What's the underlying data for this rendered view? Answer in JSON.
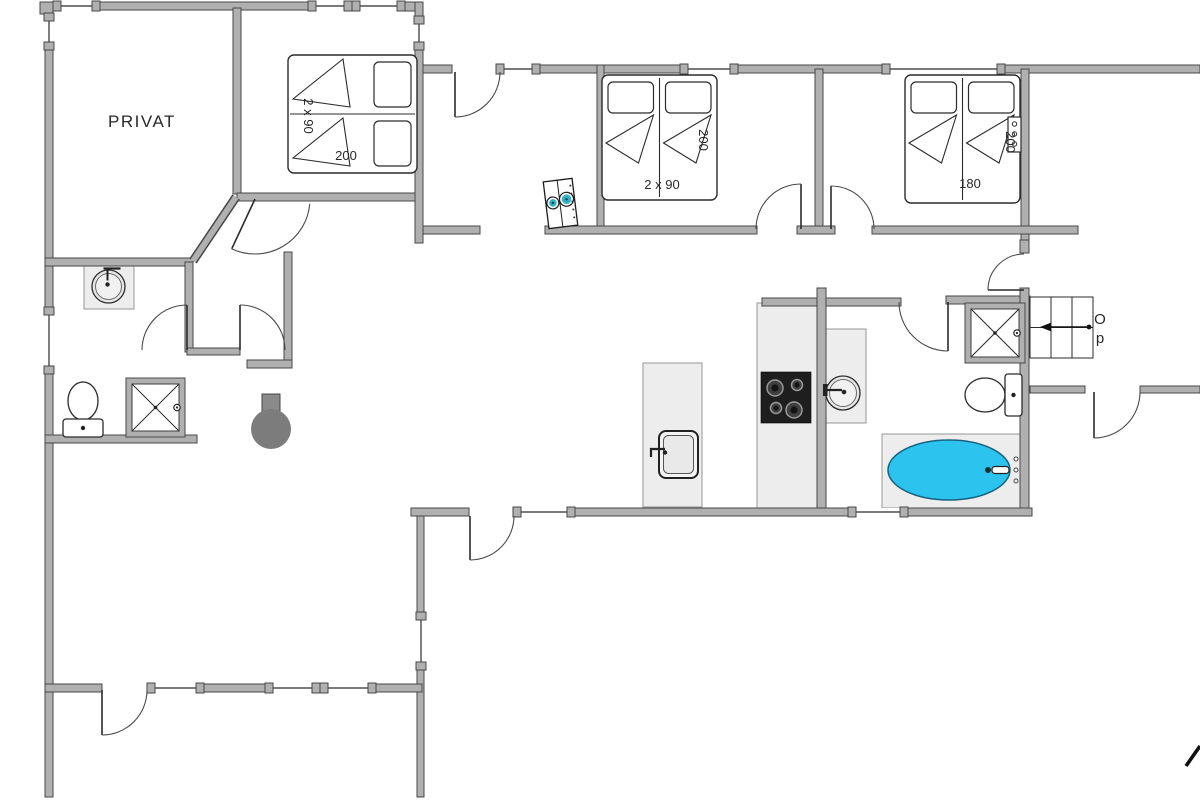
{
  "meta": {
    "width": 1200,
    "height": 800
  },
  "colors": {
    "wall": "#b0b0b0",
    "wallStroke": "#474747",
    "line": "#2b2b2b",
    "door": "#4a4a4a",
    "counter": "#ededed",
    "counterStroke": "#979797",
    "tub": "#2cc3ee",
    "tubStroke": "#16637f",
    "appliance": "#2fb3c4",
    "stove": "#1e1e1e",
    "fireplace": "#7c7c7c",
    "text": "#282828"
  },
  "labels": [
    {
      "id": "privat-room",
      "text": "PRIVAT",
      "x": 142,
      "y": 127,
      "size": 17,
      "rot": 0,
      "ls": 1.5
    },
    {
      "id": "bed-left-size",
      "text": "2 x 90",
      "x": 304,
      "y": 116,
      "size": 13,
      "rot": 90,
      "ls": 0
    },
    {
      "id": "bed-left-length",
      "text": "200",
      "x": 346,
      "y": 160,
      "size": 13,
      "rot": 0,
      "ls": 0
    },
    {
      "id": "bed-middle-size",
      "text": "2 x 90",
      "x": 662,
      "y": 189,
      "size": 13,
      "rot": 0,
      "ls": 0
    },
    {
      "id": "bed-middle-length",
      "text": "200",
      "x": 699,
      "y": 140,
      "size": 13,
      "rot": 90,
      "ls": 0
    },
    {
      "id": "bed-right-size",
      "text": "180",
      "x": 970,
      "y": 188,
      "size": 13,
      "rot": 0,
      "ls": 0
    },
    {
      "id": "bed-right-length",
      "text": "200",
      "x": 1006,
      "y": 142,
      "size": 13,
      "rot": 90,
      "ls": 0
    },
    {
      "id": "stairs-up-o",
      "text": "O",
      "x": 1100,
      "y": 324,
      "size": 15,
      "rot": 0,
      "ls": 0
    },
    {
      "id": "stairs-up-p",
      "text": "p",
      "x": 1100,
      "y": 343,
      "size": 15,
      "rot": 0,
      "ls": 0
    }
  ],
  "floorplan": {
    "panels": [
      {
        "name": "kitchen-counter",
        "x": 757,
        "y": 303,
        "w": 60,
        "h": 205
      },
      {
        "name": "kitchen-island",
        "x": 643,
        "y": 363,
        "w": 59,
        "h": 144
      },
      {
        "name": "bathroom-vanity",
        "x": 823,
        "y": 329,
        "w": 43,
        "h": 94
      },
      {
        "name": "washbasin-panel",
        "x": 84,
        "y": 264,
        "w": 50,
        "h": 45
      },
      {
        "name": "bathtub-surround",
        "x": 882,
        "y": 434,
        "w": 143,
        "h": 74
      }
    ],
    "walls": [
      [
        40,
        2,
        13,
        12
      ],
      [
        100,
        2,
        208,
        8
      ],
      [
        405,
        2,
        18,
        9
      ],
      [
        415,
        2,
        8,
        14
      ],
      [
        45,
        50,
        8,
        257
      ],
      [
        45,
        374,
        8,
        423
      ],
      [
        233,
        8,
        8,
        186
      ],
      [
        237,
        193,
        183,
        8
      ],
      [
        415,
        50,
        8,
        193
      ],
      [
        45,
        258,
        148,
        8
      ],
      [
        185,
        262,
        8,
        90
      ],
      [
        187,
        348,
        53,
        7
      ],
      [
        284,
        252,
        8,
        116
      ],
      [
        247,
        360,
        45,
        8
      ],
      [
        45,
        435,
        152,
        8
      ],
      [
        423,
        65,
        29,
        8
      ],
      [
        540,
        65,
        140,
        8
      ],
      [
        738,
        65,
        144,
        8
      ],
      [
        1005,
        65,
        195,
        8
      ],
      [
        597,
        65,
        7,
        168
      ],
      [
        815,
        69,
        8,
        162
      ],
      [
        1021,
        69,
        8,
        171
      ],
      [
        1020,
        240,
        9,
        13
      ],
      [
        423,
        226,
        57,
        8
      ],
      [
        545,
        226,
        212,
        8
      ],
      [
        797,
        226,
        38,
        8
      ],
      [
        872,
        226,
        206,
        8
      ],
      [
        762,
        298,
        139,
        8
      ],
      [
        946,
        296,
        84,
        8
      ],
      [
        817,
        288,
        9,
        222
      ],
      [
        1020,
        288,
        9,
        222
      ],
      [
        411,
        508,
        58,
        8
      ],
      [
        575,
        508,
        273,
        8
      ],
      [
        908,
        508,
        124,
        8
      ],
      [
        417,
        516,
        7,
        96
      ],
      [
        417,
        670,
        7,
        127
      ],
      [
        45,
        684,
        57,
        8
      ],
      [
        204,
        684,
        61,
        8
      ],
      [
        376,
        684,
        46,
        8
      ],
      [
        1030,
        386,
        55,
        7
      ],
      [
        1140,
        386,
        60,
        7
      ]
    ],
    "diagonalWalls": [
      {
        "x1": 193,
        "y1": 261,
        "x2": 236,
        "y2": 197
      }
    ],
    "windows": [
      {
        "o": "h",
        "x": 53,
        "y": 2,
        "len": 47
      },
      {
        "o": "h",
        "x": 308,
        "y": 2,
        "len": 44
      },
      {
        "o": "h",
        "x": 352,
        "y": 2,
        "len": 53
      },
      {
        "o": "v",
        "x": 45,
        "y": 13,
        "len": 37
      },
      {
        "o": "v",
        "x": 415,
        "y": 16,
        "len": 34
      },
      {
        "o": "v",
        "x": 45,
        "y": 307,
        "len": 67
      },
      {
        "o": "h",
        "x": 496,
        "y": 65,
        "len": 44
      },
      {
        "o": "h",
        "x": 680,
        "y": 65,
        "len": 58
      },
      {
        "o": "h",
        "x": 882,
        "y": 65,
        "len": 123
      },
      {
        "o": "h",
        "x": 513,
        "y": 508,
        "len": 62
      },
      {
        "o": "h",
        "x": 848,
        "y": 508,
        "len": 60
      },
      {
        "o": "v",
        "x": 417,
        "y": 612,
        "len": 58
      },
      {
        "o": "h",
        "x": 147,
        "y": 684,
        "len": 57
      },
      {
        "o": "h",
        "x": 265,
        "y": 684,
        "len": 55
      },
      {
        "o": "h",
        "x": 320,
        "y": 684,
        "len": 56
      }
    ],
    "doors": [
      {
        "id": "entry",
        "x": 455,
        "y": 72,
        "r": 45,
        "leaf": 90,
        "open": 0,
        "sweep": 0
      },
      {
        "id": "privat",
        "x": 255,
        "y": 199,
        "r": 55,
        "leaf": 115,
        "open": 5,
        "sweep": 0
      },
      {
        "id": "bath-left",
        "x": 187,
        "y": 350,
        "r": 45,
        "leaf": 270,
        "open": 180,
        "sweep": 0
      },
      {
        "id": "corridor",
        "x": 240,
        "y": 350,
        "r": 45,
        "leaf": 270,
        "open": 360,
        "sweep": 1
      },
      {
        "id": "bedroom-middle",
        "x": 801,
        "y": 229,
        "r": 45,
        "leaf": 270,
        "open": 180,
        "sweep": 0
      },
      {
        "id": "bedroom-right",
        "x": 831,
        "y": 229,
        "r": 43,
        "leaf": 270,
        "open": 360,
        "sweep": 1
      },
      {
        "id": "bath-main",
        "x": 948,
        "y": 302,
        "r": 49,
        "leaf": 90,
        "open": 180,
        "sweep": 1
      },
      {
        "id": "vestibule",
        "x": 1024,
        "y": 290,
        "r": 36,
        "leaf": 180,
        "open": 270,
        "sweep": 1
      },
      {
        "id": "hall-right",
        "x": 1094,
        "y": 392,
        "r": 46,
        "leaf": 90,
        "open": 0,
        "sweep": 0
      },
      {
        "id": "living",
        "x": 470,
        "y": 516,
        "r": 44,
        "leaf": 90,
        "open": 0,
        "sweep": 0
      },
      {
        "id": "terrace",
        "x": 102,
        "y": 690,
        "r": 45,
        "leaf": 90,
        "open": 0,
        "sweep": 0
      }
    ],
    "beds": [
      {
        "id": "bed-left-twin",
        "x": 288,
        "y": 55,
        "w": 129,
        "h": 118,
        "orient": "h"
      },
      {
        "id": "bed-middle-twin",
        "x": 602,
        "y": 75,
        "w": 115,
        "h": 125,
        "orient": "v"
      },
      {
        "id": "bed-right-double",
        "x": 905,
        "y": 75,
        "w": 115,
        "h": 128,
        "orient": "v"
      }
    ],
    "stairs": {
      "x": 1030,
      "y": 297,
      "w": 63,
      "h": 61,
      "cols": 3,
      "rows": 2,
      "arrow": {
        "x1": 1089,
        "y1": 327,
        "x2": 1048,
        "y2": 327
      }
    },
    "fixtures": {
      "stove": {
        "x": 761,
        "y": 372,
        "w": 50,
        "h": 51,
        "burners": [
          [
            775,
            388,
            8
          ],
          [
            797,
            385,
            5.5
          ],
          [
            776,
            408,
            5.5
          ],
          [
            794,
            410,
            8
          ]
        ]
      },
      "islandSink": {
        "x": 659,
        "y": 431,
        "w": 39,
        "h": 47
      },
      "washBasins": [
        {
          "cx": 108.5,
          "cy": 286.5,
          "r": 16.5,
          "tap": "top"
        },
        {
          "cx": 843,
          "cy": 393,
          "r": 17,
          "tap": "left"
        }
      ],
      "toilets": [
        {
          "bx": 83,
          "by": 401,
          "rx": 15,
          "ry": 19,
          "tank": [
            63,
            419,
            40,
            18
          ],
          "orient": "v"
        },
        {
          "bx": 985,
          "by": 395,
          "rx": 20,
          "ry": 17,
          "tank": [
            1005,
            374,
            17,
            42
          ],
          "orient": "h"
        }
      ],
      "showers": [
        {
          "x": 126,
          "y": 378,
          "s": 59
        },
        {
          "x": 965,
          "y": 303,
          "s": 60
        }
      ],
      "tub": {
        "cx": 949,
        "cy": 470,
        "rx": 61,
        "ry": 30,
        "faucet": [
          988,
          470
        ],
        "spout": [
          992,
          466.5,
          17,
          7
        ],
        "knobs": [
          [
            1016,
            459
          ],
          [
            1016,
            470
          ],
          [
            1016,
            481
          ]
        ]
      },
      "fireplace": {
        "cx": 271,
        "cy": 429,
        "r": 20,
        "flue": [
          262,
          394,
          18,
          25
        ]
      },
      "washer": {
        "x": 546,
        "y": 180,
        "w": 29,
        "h": 47,
        "rot": -7,
        "drums": [
          [
            553,
            202,
            6
          ],
          [
            567,
            200,
            7
          ]
        ],
        "dots": [
          [
            572.5,
            187
          ],
          [
            572.5,
            195
          ],
          [
            572.5,
            203
          ],
          [
            572.5,
            211
          ],
          [
            572.5,
            219
          ]
        ]
      },
      "nightstand": {
        "x": 1008,
        "y": 117,
        "w": 13,
        "h": 35,
        "knobs": [
          [
            1014.5,
            124
          ],
          [
            1014.5,
            134
          ],
          [
            1014.5,
            144
          ]
        ]
      },
      "northMark": {
        "x1": 1186,
        "y1": 766,
        "x2": 1200,
        "y2": 746
      }
    }
  }
}
